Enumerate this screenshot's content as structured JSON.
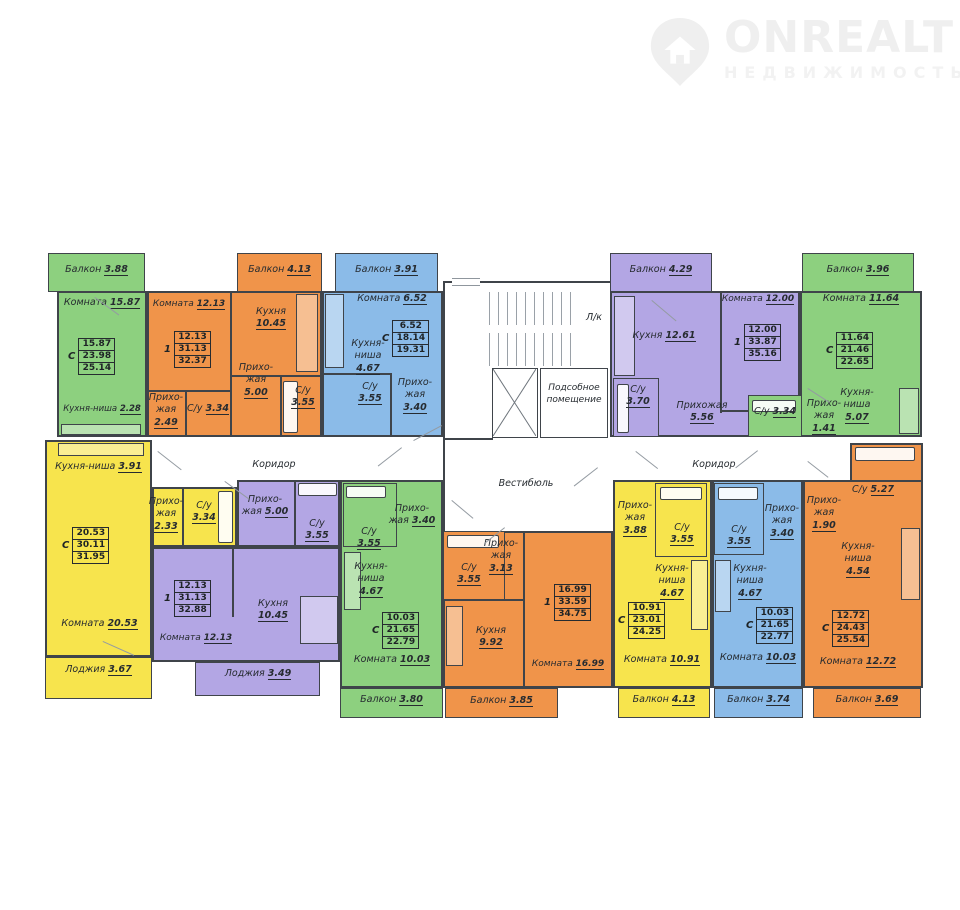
{
  "logo": {
    "brand": "ONREALT",
    "tagline": "НЕДВИЖИМОСТЬ"
  },
  "common": {
    "stairs": "Л/к",
    "utility": "Подсобное помещение",
    "vestibule": "Вестибюль",
    "corridor": "Коридор"
  },
  "legend_colors": {
    "green": "#8dd07f",
    "orange": "#f0944a",
    "blue": "#8bbbe8",
    "purple": "#b3a6e4",
    "yellow": "#f7e44d",
    "wall": "#3f444a"
  },
  "apartments": {
    "a0": {
      "t": "С",
      "s": [
        "15.87",
        "23.98",
        "25.14"
      ],
      "r": {
        "balcony": {
          "n": "Балкон",
          "v": "3.88"
        },
        "room": {
          "n": "Комната",
          "v": "15.87"
        },
        "kitchen": {
          "n": "Кухня-ниша",
          "v": "2.28"
        }
      }
    },
    "a1": {
      "t": "1",
      "s": [
        "12.13",
        "31.13",
        "32.37"
      ],
      "r": {
        "balcony": {
          "n": "Балкон",
          "v": "4.13"
        },
        "room": {
          "n": "Комната",
          "v": "12.13"
        },
        "kitchen": {
          "n": "Кухня",
          "v": "10.45"
        },
        "hall1": {
          "n": "Прихо-жая",
          "v": "2.49"
        },
        "bath1": {
          "n": "С/у",
          "v": "3.34"
        },
        "hall2": {
          "n": "Прихо-жая",
          "v": "5.00"
        },
        "bath2": {
          "n": "С/у",
          "v": "3.55"
        }
      }
    },
    "a2": {
      "t": "С",
      "s": [
        "6.52",
        "18.14",
        "19.31"
      ],
      "r": {
        "balcony": {
          "n": "Балкон",
          "v": "3.91"
        },
        "room": {
          "n": "Комната",
          "v": "6.52"
        },
        "kitchen": {
          "n": "Кухня-ниша",
          "v": "4.67"
        },
        "bath": {
          "n": "С/у",
          "v": "3.55"
        },
        "hall": {
          "n": "Прихо-жая",
          "v": "3.40"
        }
      }
    },
    "a3": {
      "t": "1",
      "s": [
        "12.00",
        "33.87",
        "35.16"
      ],
      "r": {
        "balcony": {
          "n": "Балкон",
          "v": "4.29"
        },
        "kitchen": {
          "n": "Кухня",
          "v": "12.61"
        },
        "room": {
          "n": "Комната",
          "v": "12.00"
        },
        "bath": {
          "n": "С/у",
          "v": "3.70"
        },
        "hall": {
          "n": "Прихожая",
          "v": "5.56"
        }
      }
    },
    "a4": {
      "t": "С",
      "s": [
        "11.64",
        "21.46",
        "22.65"
      ],
      "r": {
        "balcony": {
          "n": "Балкон",
          "v": "3.96"
        },
        "room": {
          "n": "Комната",
          "v": "11.64"
        },
        "kitchen": {
          "n": "Кухня-ниша",
          "v": "5.07"
        },
        "hall": {
          "n": "Прихо-жая",
          "v": "1.41"
        },
        "bath": {
          "n": "С/у",
          "v": "3.34"
        }
      }
    },
    "a5": {
      "t": "С",
      "s": [
        "20.53",
        "30.11",
        "31.95"
      ],
      "r": {
        "kitchen": {
          "n": "Кухня-ниша",
          "v": "3.91"
        },
        "hall": {
          "n": "Прихо-жая",
          "v": "2.33"
        },
        "bath": {
          "n": "С/у",
          "v": "3.34"
        },
        "room": {
          "n": "Комната",
          "v": "20.53"
        },
        "loggia": {
          "n": "Лоджия",
          "v": "3.67"
        }
      }
    },
    "a6": {
      "t": "1",
      "s": [
        "12.13",
        "31.13",
        "32.88"
      ],
      "r": {
        "hall": {
          "n": "Прихо-жая",
          "v": "5.00"
        },
        "bath": {
          "n": "С/у",
          "v": "3.55"
        },
        "kitchen": {
          "n": "Кухня",
          "v": "10.45"
        },
        "room": {
          "n": "Комната",
          "v": "12.13"
        },
        "loggia": {
          "n": "Лоджия",
          "v": "3.49"
        }
      }
    },
    "a7": {
      "t": "С",
      "s": [
        "10.03",
        "21.65",
        "22.79"
      ],
      "r": {
        "hall": {
          "n": "Прихо-жая",
          "v": "3.40"
        },
        "bath": {
          "n": "С/у",
          "v": "3.55"
        },
        "kitchen": {
          "n": "Кухня-ниша",
          "v": "4.67"
        },
        "room": {
          "n": "Комната",
          "v": "10.03"
        },
        "balcony": {
          "n": "Балкон",
          "v": "3.80"
        }
      }
    },
    "a8": {
      "t": "1",
      "s": [
        "16.99",
        "33.59",
        "34.75"
      ],
      "r": {
        "hall": {
          "n": "Прихо-жая",
          "v": "3.13"
        },
        "bath": {
          "n": "С/у",
          "v": "3.55"
        },
        "kitchen": {
          "n": "Кухня",
          "v": "9.92"
        },
        "room": {
          "n": "Комната",
          "v": "16.99"
        },
        "balcony": {
          "n": "Балкон",
          "v": "3.85"
        }
      }
    },
    "a9": {
      "t": "С",
      "s": [
        "10.91",
        "23.01",
        "24.25"
      ],
      "r": {
        "hall": {
          "n": "Прихо-жая",
          "v": "3.88"
        },
        "bath": {
          "n": "С/у",
          "v": "3.55"
        },
        "kitchen": {
          "n": "Кухня-ниша",
          "v": "4.67"
        },
        "room": {
          "n": "Комната",
          "v": "10.91"
        },
        "balcony": {
          "n": "Балкон",
          "v": "4.13"
        }
      }
    },
    "a10": {
      "t": "С",
      "s": [
        "10.03",
        "21.65",
        "22.77"
      ],
      "r": {
        "hall": {
          "n": "Прихо-жая",
          "v": "3.40"
        },
        "bath": {
          "n": "С/у",
          "v": "3.55"
        },
        "kitchen": {
          "n": "Кухня-ниша",
          "v": "4.67"
        },
        "room": {
          "n": "Комната",
          "v": "10.03"
        },
        "balcony": {
          "n": "Балкон",
          "v": "3.74"
        }
      }
    },
    "a11": {
      "t": "С",
      "s": [
        "12.72",
        "24.43",
        "25.54"
      ],
      "r": {
        "hall": {
          "n": "Прихо-жая",
          "v": "1.90"
        },
        "bath": {
          "n": "С/у",
          "v": "5.27"
        },
        "kitchen": {
          "n": "Кухня-ниша",
          "v": "4.54"
        },
        "room": {
          "n": "Комната",
          "v": "12.72"
        },
        "balcony": {
          "n": "Балкон",
          "v": "3.69"
        }
      }
    }
  }
}
